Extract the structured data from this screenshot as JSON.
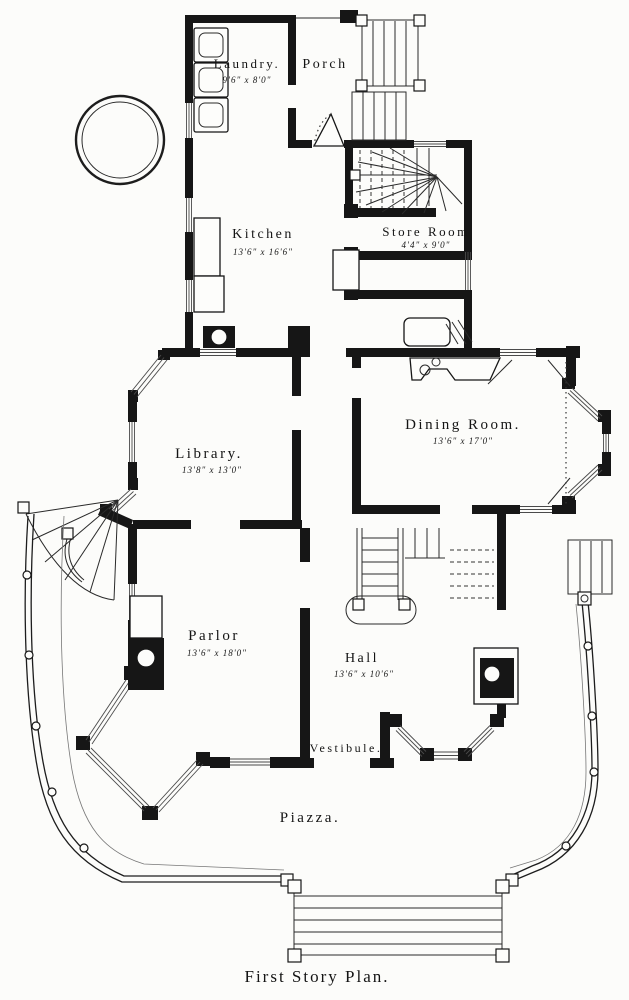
{
  "caption": "First Story Plan.",
  "rooms": {
    "laundry": {
      "name": "Laundry.",
      "dims": "9'6\" x 8'0\""
    },
    "porch": {
      "name": "Porch"
    },
    "kitchen": {
      "name": "Kitchen",
      "dims": "13'6\" x 16'6\""
    },
    "store_room": {
      "name": "Store Room",
      "dims": "4'4\" x 9'0\""
    },
    "library": {
      "name": "Library.",
      "dims": "13'8\" x 13'0\""
    },
    "dining_room": {
      "name": "Dining Room.",
      "dims": "13'6\" x 17'0\""
    },
    "parlor": {
      "name": "Parlor",
      "dims": "13'6\" x 18'0\""
    },
    "hall": {
      "name": "Hall",
      "dims": "13'6\" x 10'6\""
    },
    "vestibule": {
      "name": "Vestibule."
    },
    "piazza": {
      "name": "Piazza."
    }
  },
  "colors": {
    "ink": "#161616",
    "paper": "#fcfcfa"
  }
}
